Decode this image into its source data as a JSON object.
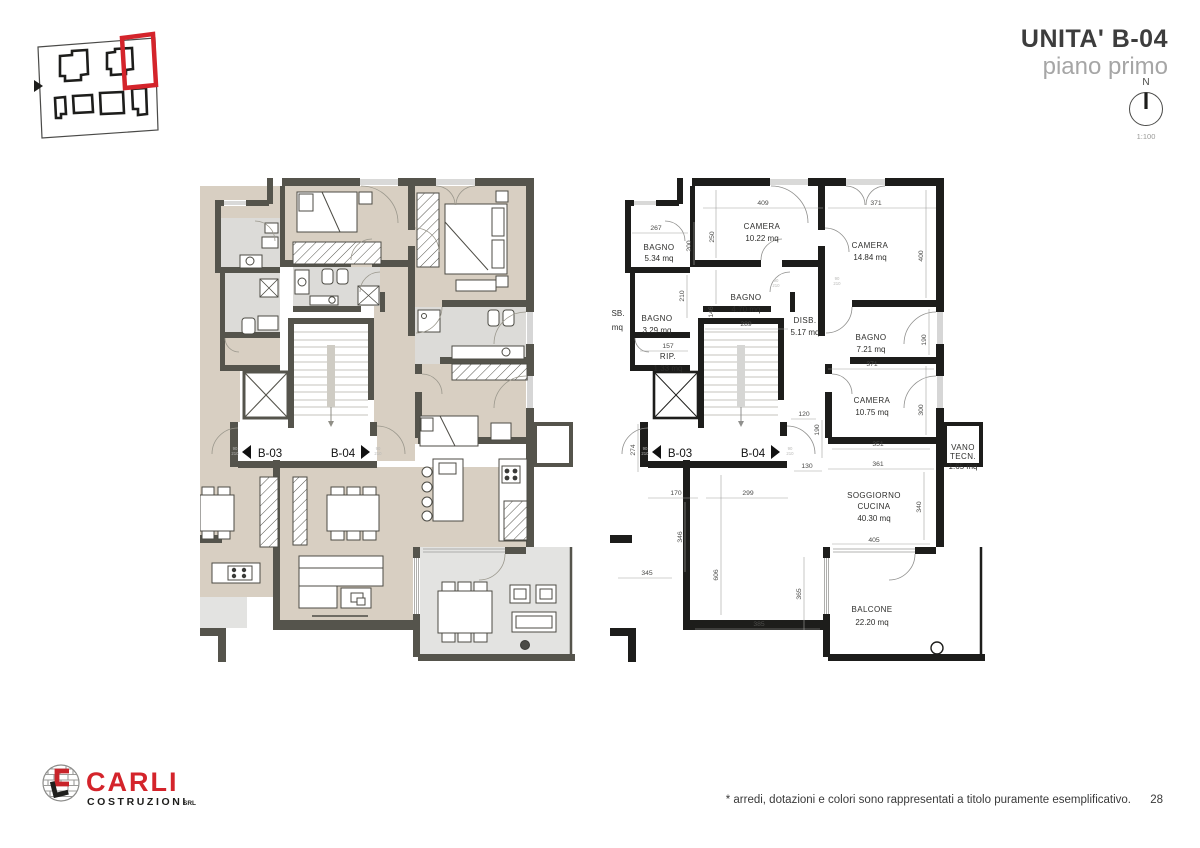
{
  "header": {
    "title": "UNITA' B-04",
    "subtitle": "piano primo",
    "north": {
      "label": "N",
      "scale": "1:100"
    }
  },
  "units": {
    "left": "B-03",
    "right": "B-04"
  },
  "technical_plan": {
    "rooms": [
      {
        "name": "BAGNO",
        "area": "5.34 mq"
      },
      {
        "name": "CAMERA",
        "area": "10.22 mq"
      },
      {
        "name": "CAMERA",
        "area": "14.84 mq"
      },
      {
        "name": "BAGNO",
        "area": "4.70 mq"
      },
      {
        "name": "BAGNO",
        "area": "3.29 mq"
      },
      {
        "name": "RIP.",
        "area": "1.33 mq"
      },
      {
        "name": "DISB.",
        "area": "5.17 mq"
      },
      {
        "name": "BAGNO",
        "area": "7.21 mq"
      },
      {
        "name": "CAMERA",
        "area": "10.75 mq"
      },
      {
        "name": "VANO",
        "name2": "TECN.",
        "area": "1.65 mq"
      },
      {
        "name": "SOGGIORNO",
        "name2": "CUCINA",
        "area": "40.30 mq"
      },
      {
        "name": "BALCONE",
        "area": "22.20 mq"
      }
    ],
    "clipped_room": {
      "l1": "SB.",
      "l2": "0 mq"
    },
    "door_tag": {
      "w": "90",
      "h": "210"
    },
    "dims": [
      "409",
      "250",
      "371",
      "400",
      "267",
      "200",
      "210",
      "146",
      "289",
      "157",
      "371",
      "190",
      "120",
      "190",
      "351",
      "361",
      "130",
      "300",
      "274",
      "170",
      "299",
      "346",
      "345",
      "606",
      "340",
      "405",
      "365",
      "385"
    ]
  },
  "footer": {
    "brand": {
      "name": "CARLI",
      "sub": "COSTRUZIONI",
      "suffix": "SRL"
    },
    "disclaimer": "* arredi, dotazioni e colori sono rappresentati a titolo puramente esemplificativo.",
    "page_number": "28"
  },
  "colors": {
    "accent_red": "#d4242b",
    "wall_dark_furnished": "#55544c",
    "wall_black": "#1d1d1b",
    "floor_beige": "#d8cfc2",
    "floor_bath_gray": "#dcdbd8",
    "floor_balcony_gray": "#e3e3e1"
  }
}
